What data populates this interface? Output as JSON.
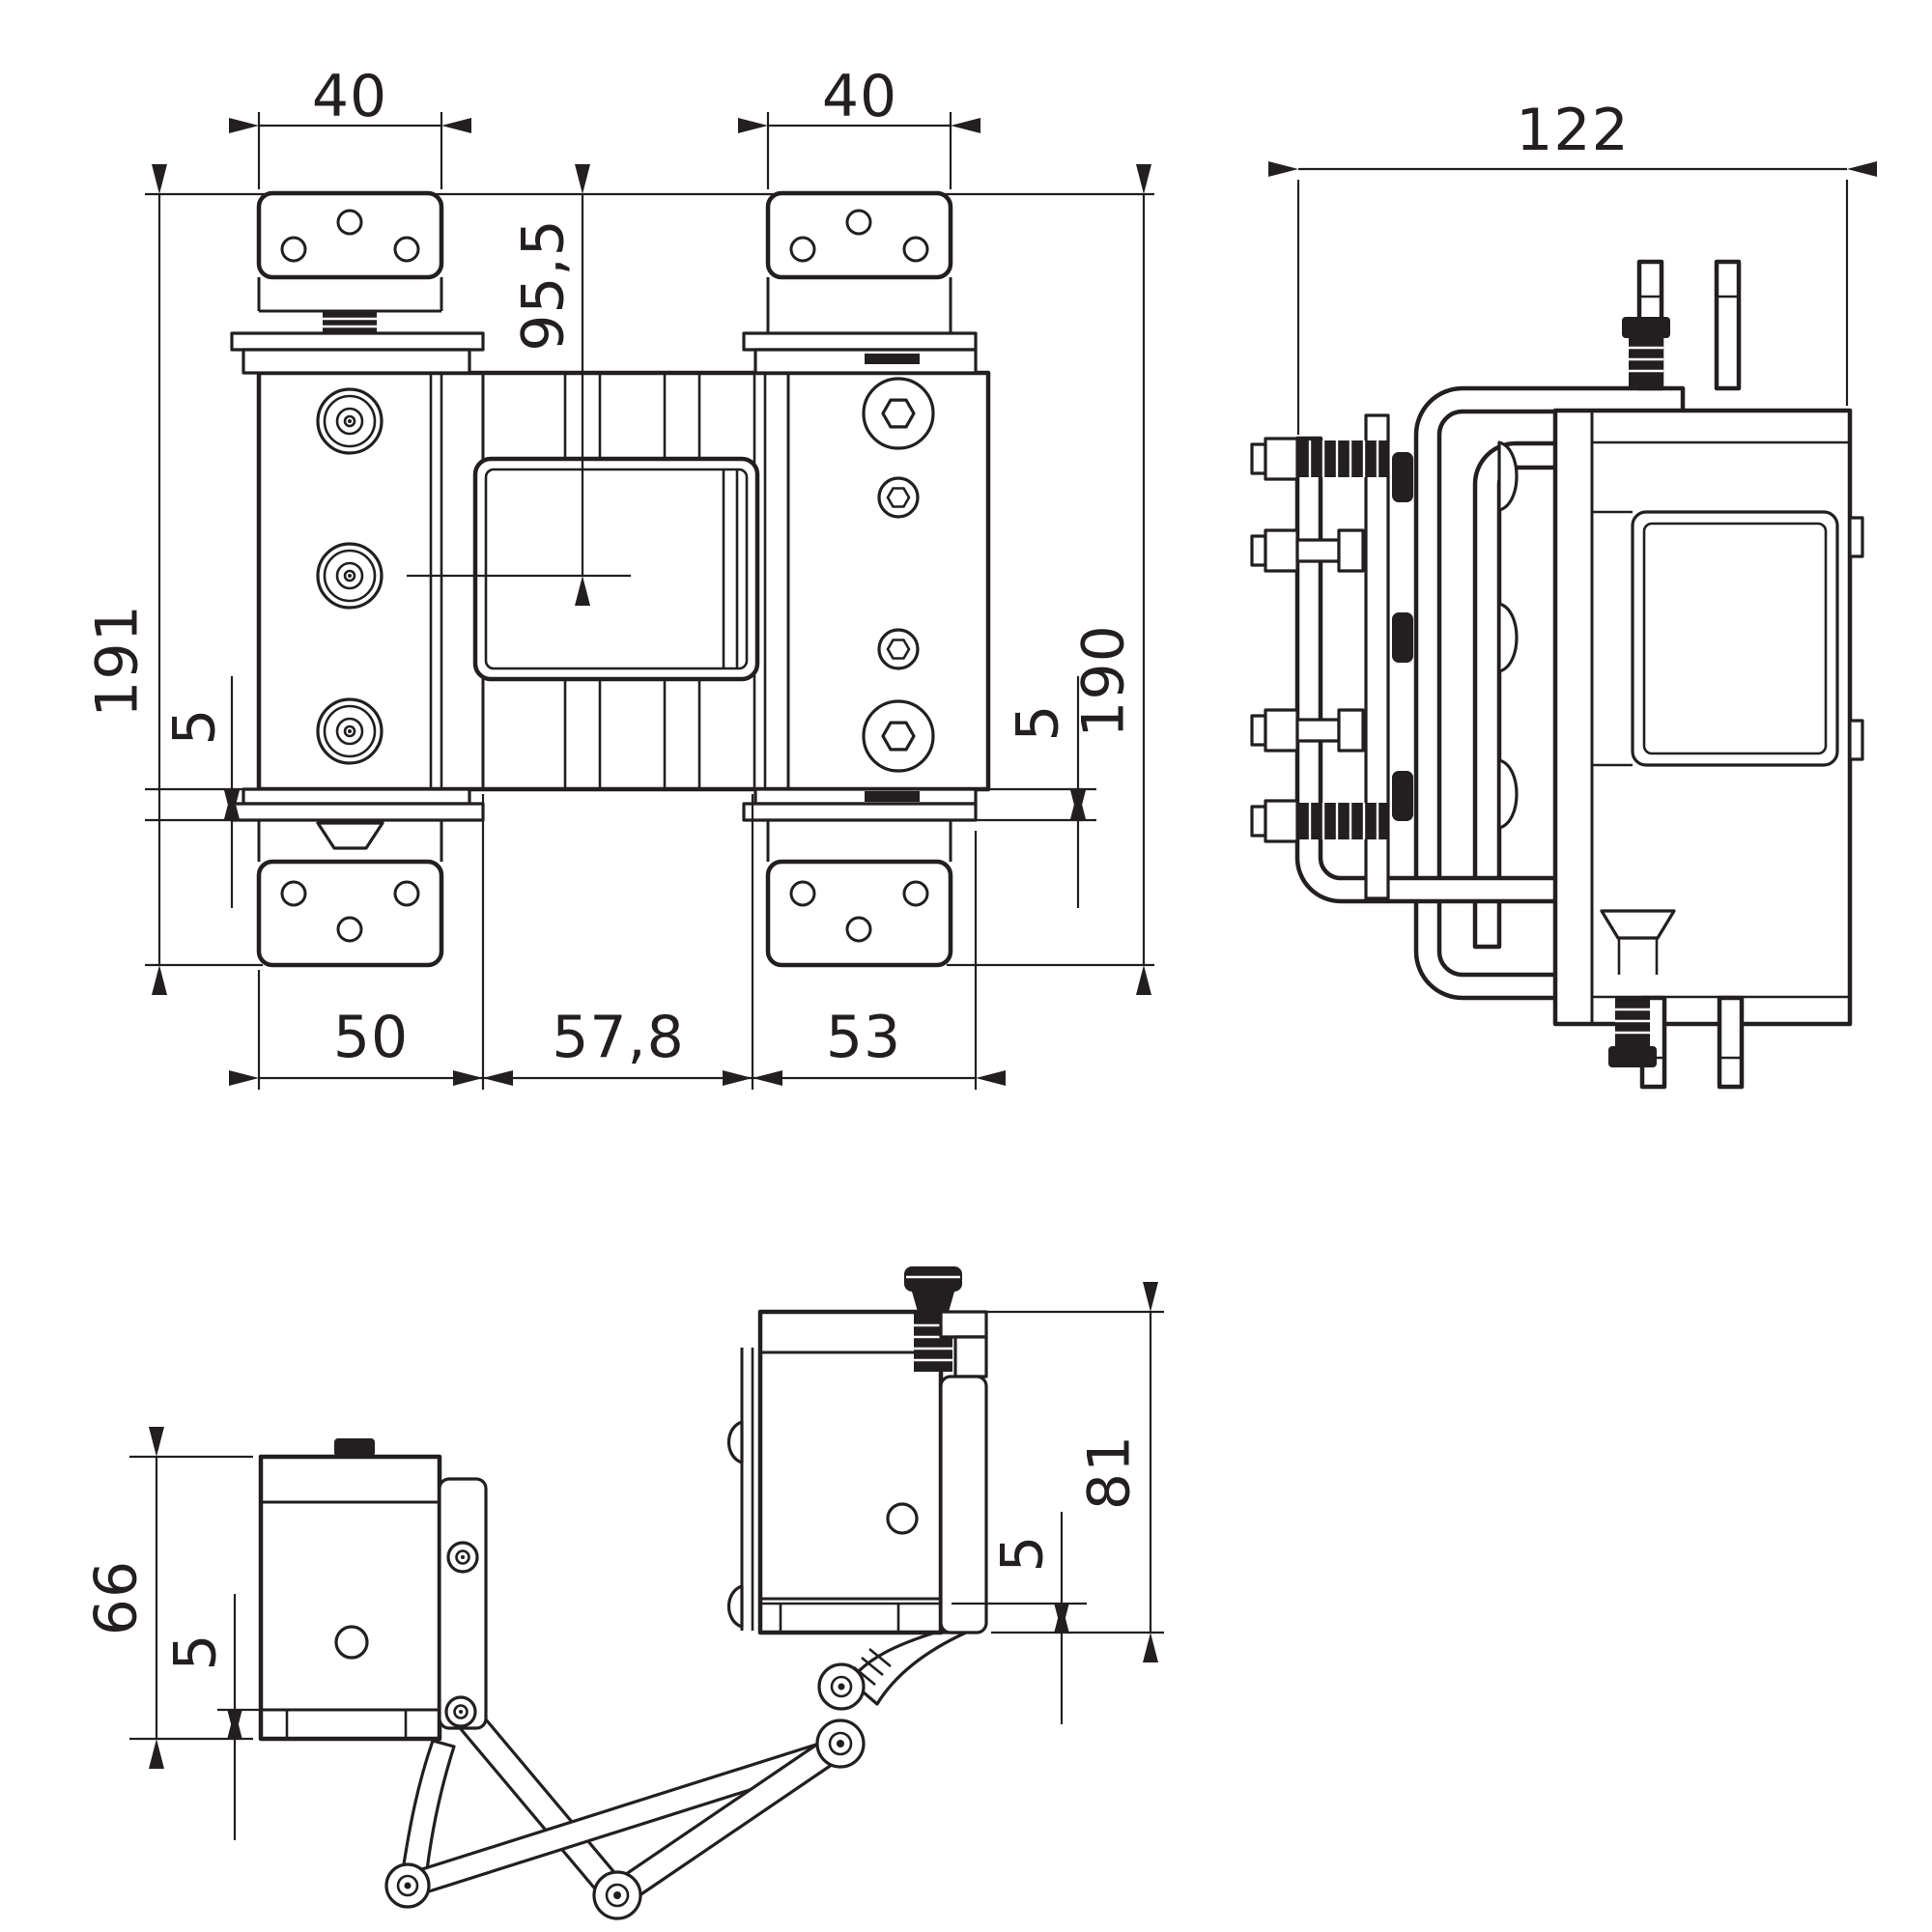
{
  "drawing": {
    "title": "Heavy-duty 3D adjustable hinge - dimensioned technical drawing",
    "background": "#ffffff",
    "line_color": "#231f20",
    "views": {
      "front": {
        "name": "front-view"
      },
      "side": {
        "name": "side-view"
      },
      "top": {
        "name": "top-view"
      }
    },
    "dimensions": {
      "front": {
        "bracket_width_left": "40",
        "bracket_width_right": "40",
        "center_from_top": "95,5",
        "height_left": "191",
        "height_right": "190",
        "gap_left": "5",
        "gap_right": "5",
        "width_left": "50",
        "width_center": "57,8",
        "width_right": "53"
      },
      "side": {
        "overall_width": "122"
      },
      "top": {
        "height_left": "66",
        "gap_left": "5",
        "height_right": "81",
        "gap_right": "5"
      }
    }
  }
}
